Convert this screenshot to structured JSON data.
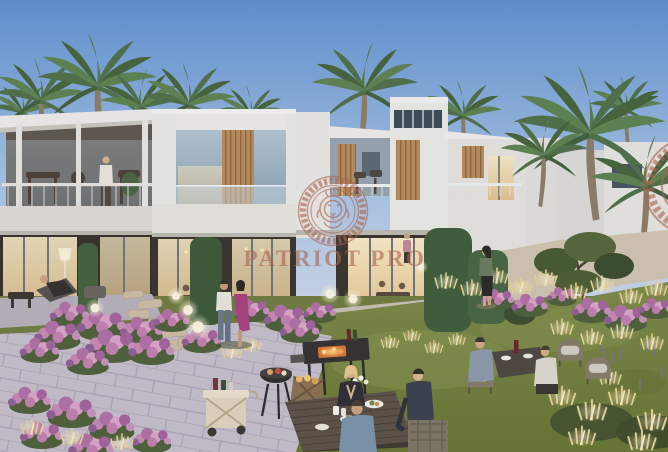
{
  "scene": {
    "type": "architectural-render",
    "time_of_day": "dusk",
    "subject": "Modern two-storey white townhouses with wood-slat accents, palm trees, landscaped flower gardens, stone pathways, outdoor BBQ area and residents dining in the garden"
  },
  "watermark": {
    "text": "PATRIOT PRO",
    "emblem": "lion-medallion",
    "color": "#a8644f"
  },
  "palette": {
    "sky_top": "#6b97d3",
    "sky_horizon": "#ccd8e9",
    "building_white": "#e9e7e2",
    "wood_accent": "#bd9062",
    "window_glow": "#f4dfae",
    "hedge_green": "#42603b",
    "lawn_green": "#74823f",
    "flower_pink": "#c888b0",
    "path_gray": "#c4bdc7",
    "garden_light": "#ecd28e"
  }
}
